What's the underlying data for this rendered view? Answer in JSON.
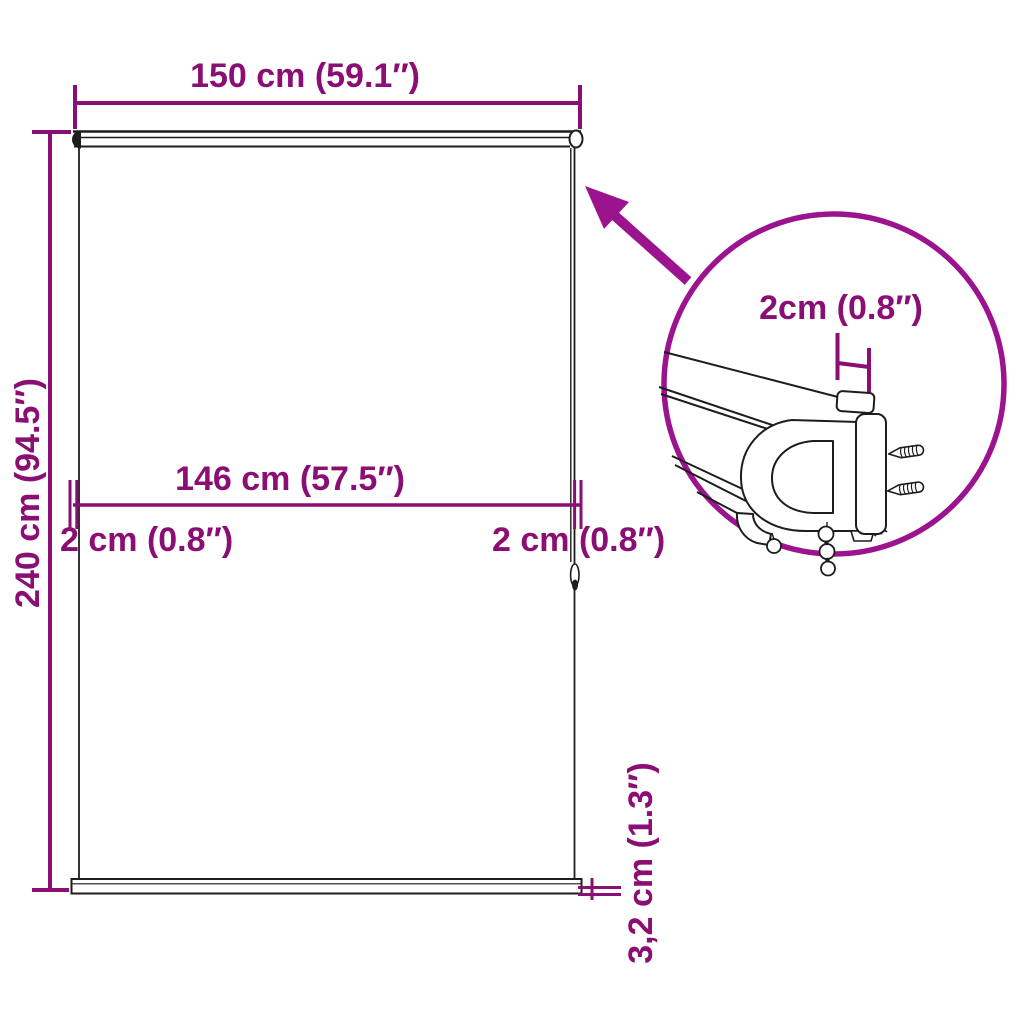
{
  "colors": {
    "dimension": "#8a0e73",
    "callout": "#9b138e",
    "line": "#1d1d1b",
    "background": "#ffffff"
  },
  "labels": {
    "total_width": "150 cm (59.1″)",
    "total_height": "240 cm (94.5″)",
    "fabric_width": "146 cm (57.5″)",
    "side_gap_left": "2 cm (0.8″)",
    "side_gap_right": "2 cm (0.8″)",
    "bottom_bar_height": "3,2 cm (1.3″)",
    "bracket_width": "2cm (0.8″)"
  }
}
